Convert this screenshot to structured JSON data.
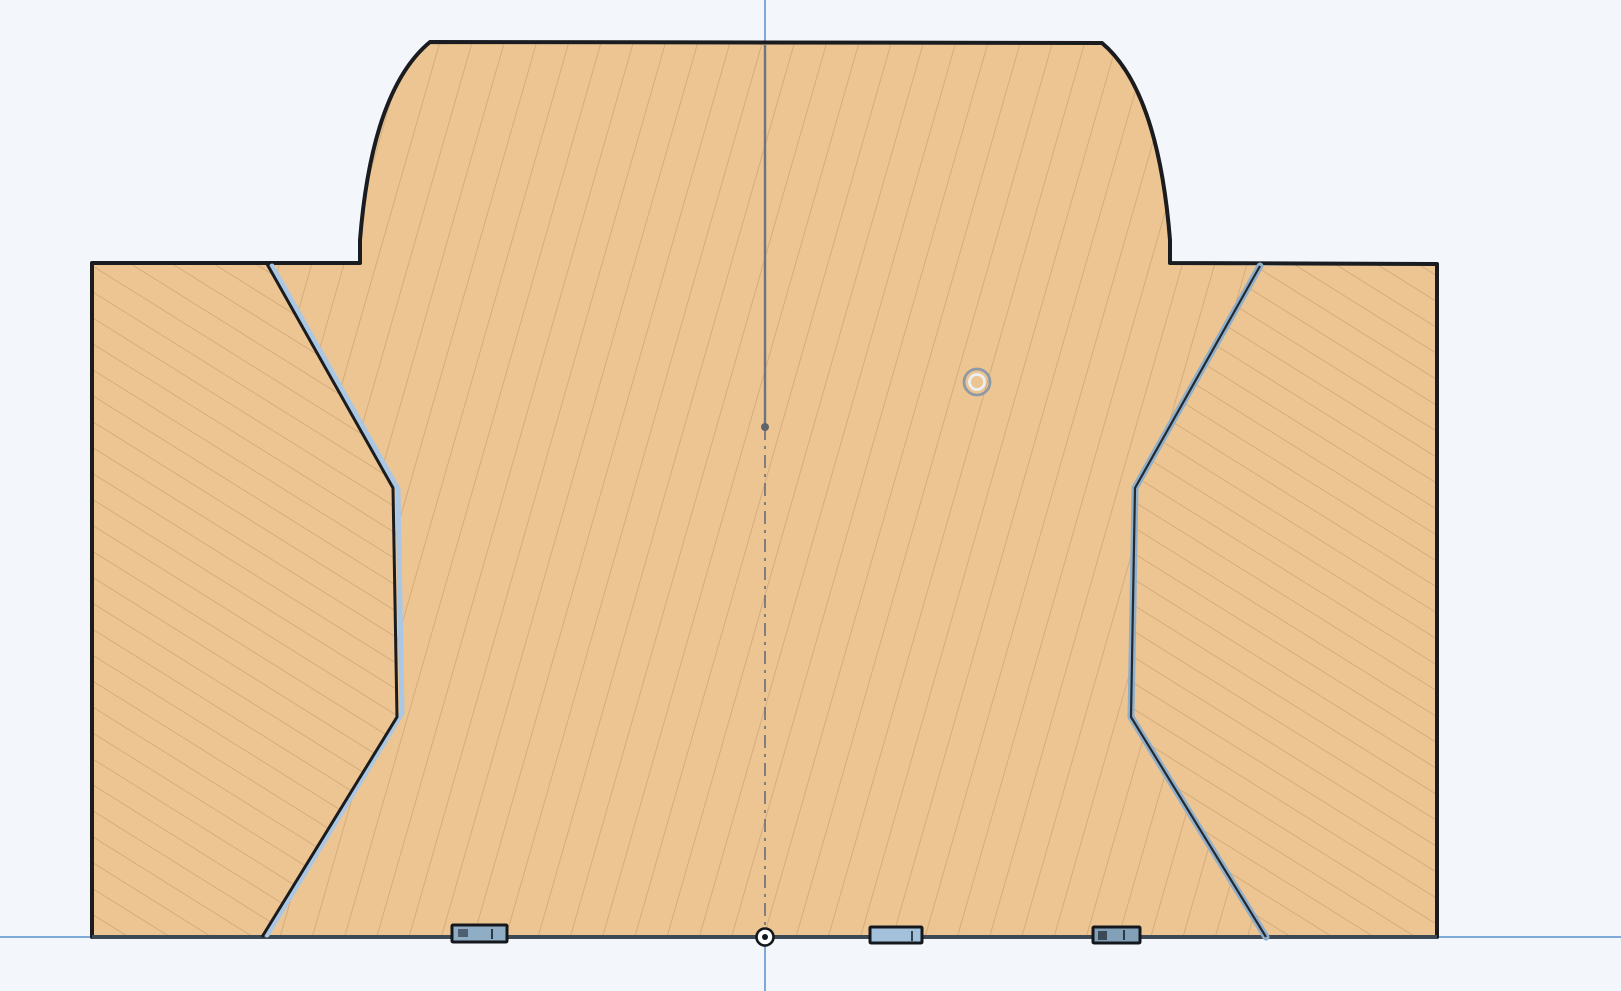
{
  "canvas": {
    "width": 1621,
    "height": 991,
    "background": "#f3f6fa"
  },
  "colors": {
    "background": "#f3f6fa",
    "part_fill": "#ecc593",
    "hatch_line": "#bb8e5e",
    "part_outline": "#1a1c1f",
    "bottom_edge": "#3d4954",
    "axis_blue": "#7fa9d9",
    "centerline_gray": "#6d747b",
    "highlight_blue_left": "#aac7e4",
    "highlight_blue_right": "#8fafcb",
    "tab_fill_left": "#8fadc4",
    "tab_fill_mid": "#a3c1da",
    "tab_fill_right": "#82a0b8",
    "ring_marker_gray": "#8d9aa5",
    "ring_marker_white": "#eaf0f5",
    "origin_ring": "#15181b"
  },
  "axes": {
    "vertical_axis_x": 765,
    "horizontal_axis_y": 937
  },
  "markers": {
    "origin": {
      "x": 765,
      "y": 937
    },
    "circle_marker": {
      "x": 977,
      "y": 382
    },
    "centerline_point": {
      "x": 765,
      "y": 427
    }
  },
  "scene": {
    "defs": [
      {
        "tag": "pattern",
        "name": "hatch-steep-pattern",
        "attrs": {
          "id": "hatch-steep",
          "width": "31",
          "height": "12",
          "patternUnits": "userSpaceOnUse",
          "patternTransform": "rotate(16)"
        },
        "children": [
          {
            "tag": "line",
            "attrs": {
              "x1": "0",
              "y1": "0",
              "x2": "0",
              "y2": "12",
              "stroke": "#bb8e5e",
              "stroke-width": "1.8",
              "opacity": "0.5"
            }
          }
        ]
      },
      {
        "tag": "pattern",
        "name": "hatch-shallow-pattern",
        "attrs": {
          "id": "hatch-shallow",
          "width": "12",
          "height": "22",
          "patternUnits": "userSpaceOnUse",
          "patternTransform": "rotate(32)"
        },
        "children": [
          {
            "tag": "line",
            "attrs": {
              "x1": "0",
              "y1": "0",
              "x2": "12",
              "y2": "0",
              "stroke": "#bb8e5e",
              "stroke-width": "1.8",
              "opacity": "0.5"
            }
          }
        ]
      }
    ],
    "elements": [
      {
        "tag": "rect",
        "name": "canvas-background",
        "interactable": false,
        "attrs": {
          "x": "0",
          "y": "0",
          "width": "1621",
          "height": "991",
          "fill": "#f3f6fa"
        }
      },
      {
        "tag": "line",
        "name": "x-axis",
        "interactable": false,
        "attrs": {
          "x1": "0",
          "y1": "937",
          "x2": "1621",
          "y2": "937",
          "stroke": "#7fa9d9",
          "stroke-width": "2"
        }
      },
      {
        "tag": "line",
        "name": "y-axis",
        "interactable": false,
        "attrs": {
          "x1": "765",
          "y1": "0",
          "x2": "765",
          "y2": "991",
          "stroke": "#7fa9d9",
          "stroke-width": "2"
        }
      },
      {
        "tag": "path",
        "name": "section-face-main-body",
        "interactable": true,
        "attrs": {
          "d": "M 267 264 L 360 263 L 360 240 Q 372 90 430 42 L 1102 43 Q 1158 90 1170 240 L 1170 263 L 1260 266 L 1135 488 L 1131 717 L 1266 937 L 262 937 L 397 717 L 393 488 Z",
          "fill": "#ecc593",
          "stroke": "none"
        }
      },
      {
        "tag": "path",
        "name": "section-hatch-main-body",
        "interactable": false,
        "attrs": {
          "d": "M 267 264 L 360 263 L 360 240 Q 372 90 430 42 L 1102 43 Q 1158 90 1170 240 L 1170 263 L 1260 266 L 1135 488 L 1131 717 L 1266 937 L 262 937 L 397 717 L 393 488 Z",
          "fill": "url(#hatch-steep)",
          "stroke": "none"
        }
      },
      {
        "tag": "path",
        "name": "section-face-left-flank",
        "interactable": true,
        "attrs": {
          "d": "M 92 263 L 267 264 L 393 488 L 397 717 L 262 937 L 92 937 Z",
          "fill": "#ecc593",
          "stroke": "none"
        }
      },
      {
        "tag": "path",
        "name": "section-hatch-left-flank",
        "interactable": false,
        "attrs": {
          "d": "M 92 263 L 267 264 L 393 488 L 397 717 L 262 937 L 92 937 Z",
          "fill": "url(#hatch-shallow)",
          "stroke": "none"
        }
      },
      {
        "tag": "path",
        "name": "section-face-right-flank",
        "interactable": true,
        "attrs": {
          "d": "M 1263 266 L 1437 264 L 1437 937 L 1266 937 L 1131 717 L 1135 488 Z",
          "fill": "#ecc593",
          "stroke": "none"
        }
      },
      {
        "tag": "path",
        "name": "section-hatch-right-flank",
        "interactable": false,
        "attrs": {
          "d": "M 1263 266 L 1437 264 L 1437 937 L 1266 937 L 1131 717 L 1135 488 Z",
          "fill": "url(#hatch-shallow)",
          "stroke": "none"
        }
      },
      {
        "tag": "path",
        "name": "part-outline",
        "interactable": true,
        "attrs": {
          "d": "M 92 263 L 360 263 L 360 240 Q 372 90 430 42 L 1102 43 Q 1158 90 1170 240 L 1170 263 L 1437 264 L 1437 937 L 92 937 Z",
          "fill": "none",
          "stroke": "#1a1c1f",
          "stroke-width": "4",
          "stroke-linejoin": "round"
        }
      },
      {
        "tag": "line",
        "name": "part-bottom-edge",
        "interactable": true,
        "attrs": {
          "x1": "92",
          "y1": "937",
          "x2": "1437",
          "y2": "937",
          "stroke": "#3d4954",
          "stroke-width": "4"
        }
      },
      {
        "tag": "line",
        "name": "section-centerline-solid",
        "interactable": false,
        "attrs": {
          "x1": "765",
          "y1": "44",
          "x2": "765",
          "y2": "427",
          "stroke": "#6d747b",
          "stroke-width": "2.4"
        }
      },
      {
        "tag": "line",
        "name": "section-centerline-dashdot",
        "interactable": false,
        "attrs": {
          "x1": "765",
          "y1": "427",
          "x2": "765",
          "y2": "935",
          "stroke": "#6d747b",
          "stroke-width": "2",
          "stroke-dasharray": "13 6 3 6",
          "opacity": "0.85"
        }
      },
      {
        "tag": "circle",
        "name": "centerline-point",
        "interactable": true,
        "attrs": {
          "cx": "765",
          "cy": "427",
          "r": "4",
          "fill": "#5d646b"
        }
      },
      {
        "tag": "polyline",
        "name": "highlighted-edge-left-blue",
        "interactable": true,
        "attrs": {
          "points": "272,266 398,489 402,713 267,935",
          "fill": "none",
          "stroke": "#aac7e4",
          "stroke-width": "5",
          "stroke-linejoin": "round",
          "stroke-linecap": "round"
        }
      },
      {
        "tag": "polyline",
        "name": "edge-left-outline",
        "interactable": true,
        "attrs": {
          "points": "267,264 393,488 397,717 262,937",
          "fill": "none",
          "stroke": "#1a1c1f",
          "stroke-width": "3",
          "stroke-linejoin": "round"
        }
      },
      {
        "tag": "polyline",
        "name": "highlighted-edge-right-blue",
        "interactable": true,
        "attrs": {
          "points": "1260,266 1135,488 1131,717 1266,937",
          "fill": "none",
          "stroke": "#8fafcb",
          "stroke-width": "7",
          "stroke-linejoin": "round",
          "stroke-linecap": "round"
        }
      },
      {
        "tag": "polyline",
        "name": "edge-right-outline",
        "interactable": true,
        "attrs": {
          "points": "1260,266 1135,488 1131,717 1266,937",
          "fill": "none",
          "stroke": "#23292e",
          "stroke-width": "2.2",
          "stroke-linejoin": "round"
        }
      },
      {
        "tag": "g",
        "name": "bottom-tab-left",
        "interactable": true,
        "attrs": {},
        "children": [
          {
            "tag": "rect",
            "attrs": {
              "x": "452",
              "y": "925",
              "width": "55",
              "height": "17",
              "rx": "1",
              "fill": "#8fadc4",
              "stroke": "#14181d",
              "stroke-width": "3"
            }
          },
          {
            "tag": "rect",
            "attrs": {
              "x": "458",
              "y": "929",
              "width": "10",
              "height": "8",
              "fill": "#4d6071"
            }
          },
          {
            "tag": "line",
            "attrs": {
              "x1": "492",
              "y1": "929",
              "x2": "492",
              "y2": "939",
              "stroke": "#2c3944",
              "stroke-width": "2"
            }
          }
        ]
      },
      {
        "tag": "g",
        "name": "bottom-tab-middle",
        "interactable": true,
        "attrs": {},
        "children": [
          {
            "tag": "rect",
            "attrs": {
              "x": "870",
              "y": "927",
              "width": "52",
              "height": "16",
              "rx": "1",
              "fill": "#a3c1da",
              "stroke": "#14181d",
              "stroke-width": "3"
            }
          },
          {
            "tag": "line",
            "attrs": {
              "x1": "912",
              "y1": "931",
              "x2": "912",
              "y2": "941",
              "stroke": "#33414d",
              "stroke-width": "2"
            }
          }
        ]
      },
      {
        "tag": "g",
        "name": "bottom-tab-right",
        "interactable": true,
        "attrs": {},
        "children": [
          {
            "tag": "rect",
            "attrs": {
              "x": "1093",
              "y": "927",
              "width": "47",
              "height": "16",
              "rx": "1",
              "fill": "#82a0b8",
              "stroke": "#14181d",
              "stroke-width": "3"
            }
          },
          {
            "tag": "rect",
            "attrs": {
              "x": "1098",
              "y": "931",
              "width": "9",
              "height": "9",
              "fill": "#3c4a57"
            }
          },
          {
            "tag": "line",
            "attrs": {
              "x1": "1124",
              "y1": "930",
              "x2": "1124",
              "y2": "940",
              "stroke": "#2c3944",
              "stroke-width": "2"
            }
          }
        ]
      },
      {
        "tag": "g",
        "name": "circle-marker",
        "interactable": true,
        "attrs": {},
        "children": [
          {
            "tag": "circle",
            "attrs": {
              "cx": "977",
              "cy": "382",
              "r": "13",
              "fill": "none",
              "stroke": "#8d9aa5",
              "stroke-width": "2.8"
            }
          },
          {
            "tag": "circle",
            "attrs": {
              "cx": "977",
              "cy": "382",
              "r": "7.5",
              "fill": "none",
              "stroke": "#eaf0f5",
              "stroke-width": "2.8"
            }
          }
        ]
      },
      {
        "tag": "g",
        "name": "origin-marker",
        "interactable": true,
        "attrs": {},
        "children": [
          {
            "tag": "circle",
            "attrs": {
              "cx": "765",
              "cy": "937",
              "r": "8.5",
              "fill": "#ffffff",
              "stroke": "#15181b",
              "stroke-width": "2.6"
            }
          },
          {
            "tag": "circle",
            "attrs": {
              "cx": "765",
              "cy": "937",
              "r": "3",
              "fill": "#15181b"
            }
          }
        ]
      }
    ]
  }
}
